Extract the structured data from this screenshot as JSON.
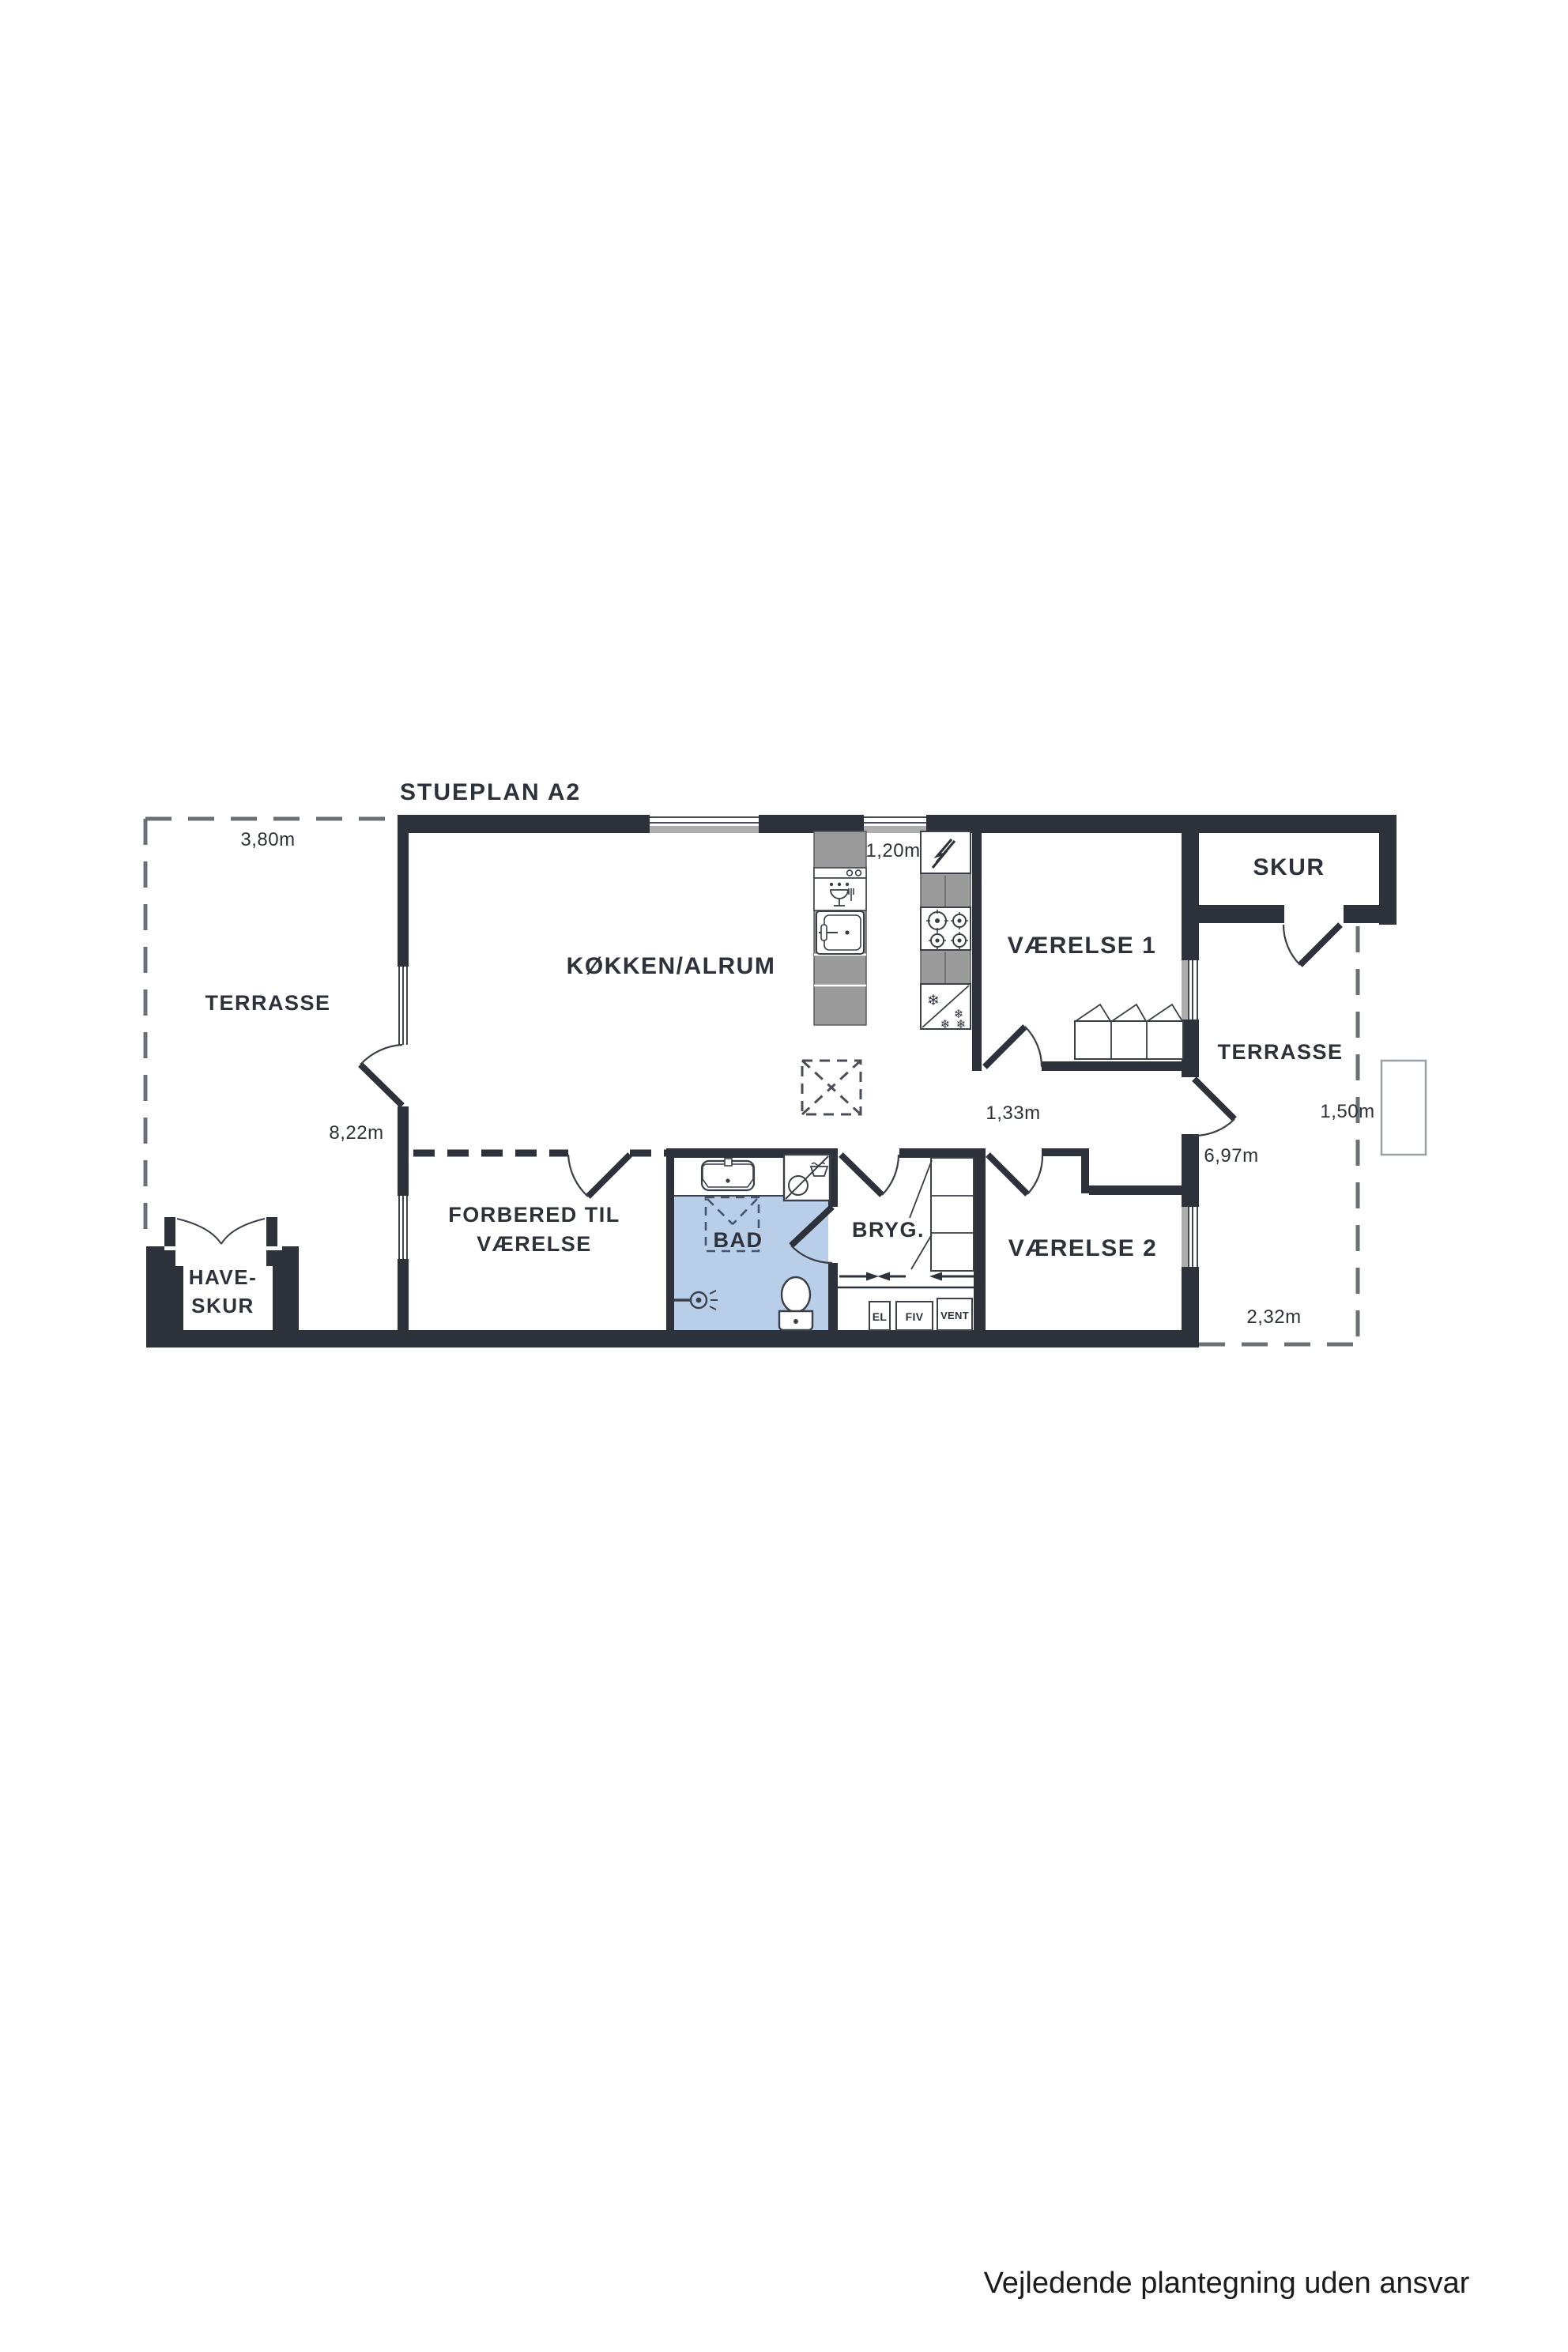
{
  "title": "STUEPLAN A2",
  "footer": "Vejledende plantegning uden ansvar",
  "rooms": {
    "kokken": "KØKKEN/ALRUM",
    "vaerelse1": "VÆRELSE 1",
    "vaerelse2": "VÆRELSE 2",
    "bad": "BAD",
    "bryg": "BRYG.",
    "forbered_line1": "FORBERED TIL",
    "forbered_line2": "VÆRELSE",
    "skur": "SKUR",
    "haveskur_line1": "HAVE-",
    "haveskur_line2": "SKUR",
    "terrasse_left": "TERRASSE",
    "terrasse_right": "TERRASSE"
  },
  "dimensions": {
    "terrace_width": "3,80m",
    "kitchen_aisle": "1,20m",
    "house_side": "8,22m",
    "hallway": "1,33m",
    "right_side": "6,97m",
    "right_terrace": "1,50m",
    "back_strip": "2,32m"
  },
  "utility": {
    "el": "EL",
    "fiv": "FIV",
    "vent": "VENT"
  },
  "icons": {
    "snowflake": "❄"
  },
  "colors": {
    "wall": "#2c313a",
    "bath_floor": "#b9cfe9",
    "counter_gray": "#9b9b9b",
    "sill_gray": "#aeaeae",
    "thin_line": "#3a3f48",
    "dash_gray": "#6b7077"
  }
}
